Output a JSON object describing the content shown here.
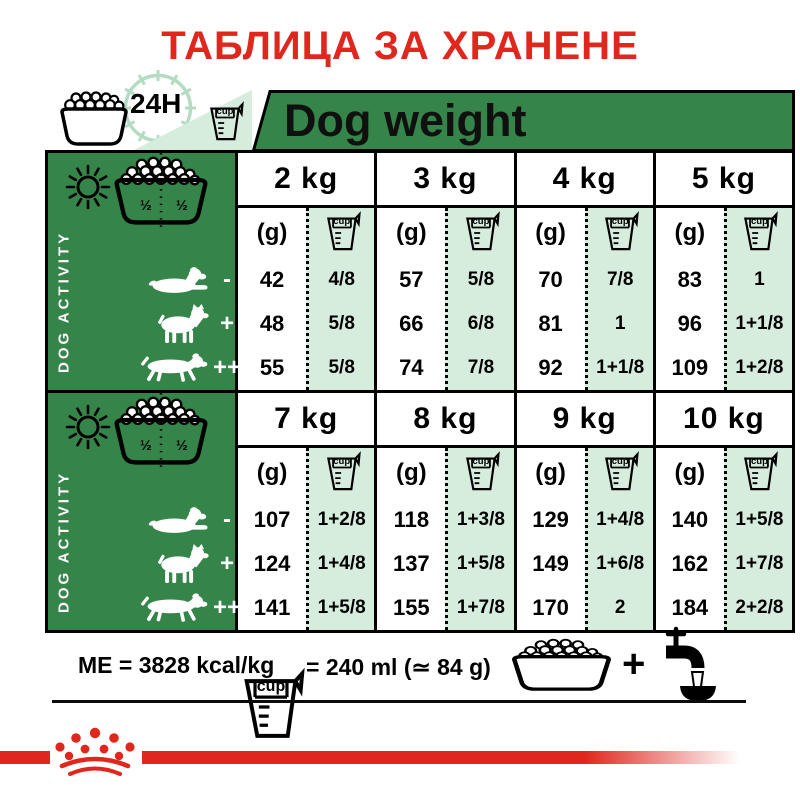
{
  "title": "ТАБЛИЦА ЗА ХРАНЕНЕ",
  "labels": {
    "clock": "24H",
    "dog_weight": "Dog weight",
    "cup": "cup",
    "grams": "(g)",
    "dog_activity": "DOG ACTIVITY",
    "half": "½"
  },
  "colors": {
    "red": "#E0271E",
    "green": "#35854A",
    "light_green": "#D6EDDE",
    "pale_green": "#B3DCC3",
    "black": "#000000"
  },
  "tables": [
    {
      "columns": [
        "2 kg",
        "3 kg",
        "4 kg",
        "5 kg"
      ],
      "rows": [
        {
          "activity": "-",
          "cells": [
            {
              "g": "42",
              "cup": "4/8"
            },
            {
              "g": "57",
              "cup": "5/8"
            },
            {
              "g": "70",
              "cup": "7/8"
            },
            {
              "g": "83",
              "cup": "1"
            }
          ]
        },
        {
          "activity": "+",
          "cells": [
            {
              "g": "48",
              "cup": "5/8"
            },
            {
              "g": "66",
              "cup": "6/8"
            },
            {
              "g": "81",
              "cup": "1"
            },
            {
              "g": "96",
              "cup": "1+1/8"
            }
          ]
        },
        {
          "activity": "++",
          "cells": [
            {
              "g": "55",
              "cup": "5/8"
            },
            {
              "g": "74",
              "cup": "7/8"
            },
            {
              "g": "92",
              "cup": "1+1/8"
            },
            {
              "g": "109",
              "cup": "1+2/8"
            }
          ]
        }
      ]
    },
    {
      "columns": [
        "7 kg",
        "8 kg",
        "9 kg",
        "10 kg"
      ],
      "rows": [
        {
          "activity": "-",
          "cells": [
            {
              "g": "107",
              "cup": "1+2/8"
            },
            {
              "g": "118",
              "cup": "1+3/8"
            },
            {
              "g": "129",
              "cup": "1+4/8"
            },
            {
              "g": "140",
              "cup": "1+5/8"
            }
          ]
        },
        {
          "activity": "+",
          "cells": [
            {
              "g": "124",
              "cup": "1+4/8"
            },
            {
              "g": "137",
              "cup": "1+5/8"
            },
            {
              "g": "149",
              "cup": "1+6/8"
            },
            {
              "g": "162",
              "cup": "1+7/8"
            }
          ]
        },
        {
          "activity": "++",
          "cells": [
            {
              "g": "141",
              "cup": "1+5/8"
            },
            {
              "g": "155",
              "cup": "1+7/8"
            },
            {
              "g": "170",
              "cup": "2"
            },
            {
              "g": "184",
              "cup": "2+2/8"
            }
          ]
        }
      ]
    }
  ],
  "footer": {
    "me": "ME = 3828 kcal/kg",
    "cup_equiv": "= 240 ml (≃ 84 g)",
    "plus": "+"
  }
}
